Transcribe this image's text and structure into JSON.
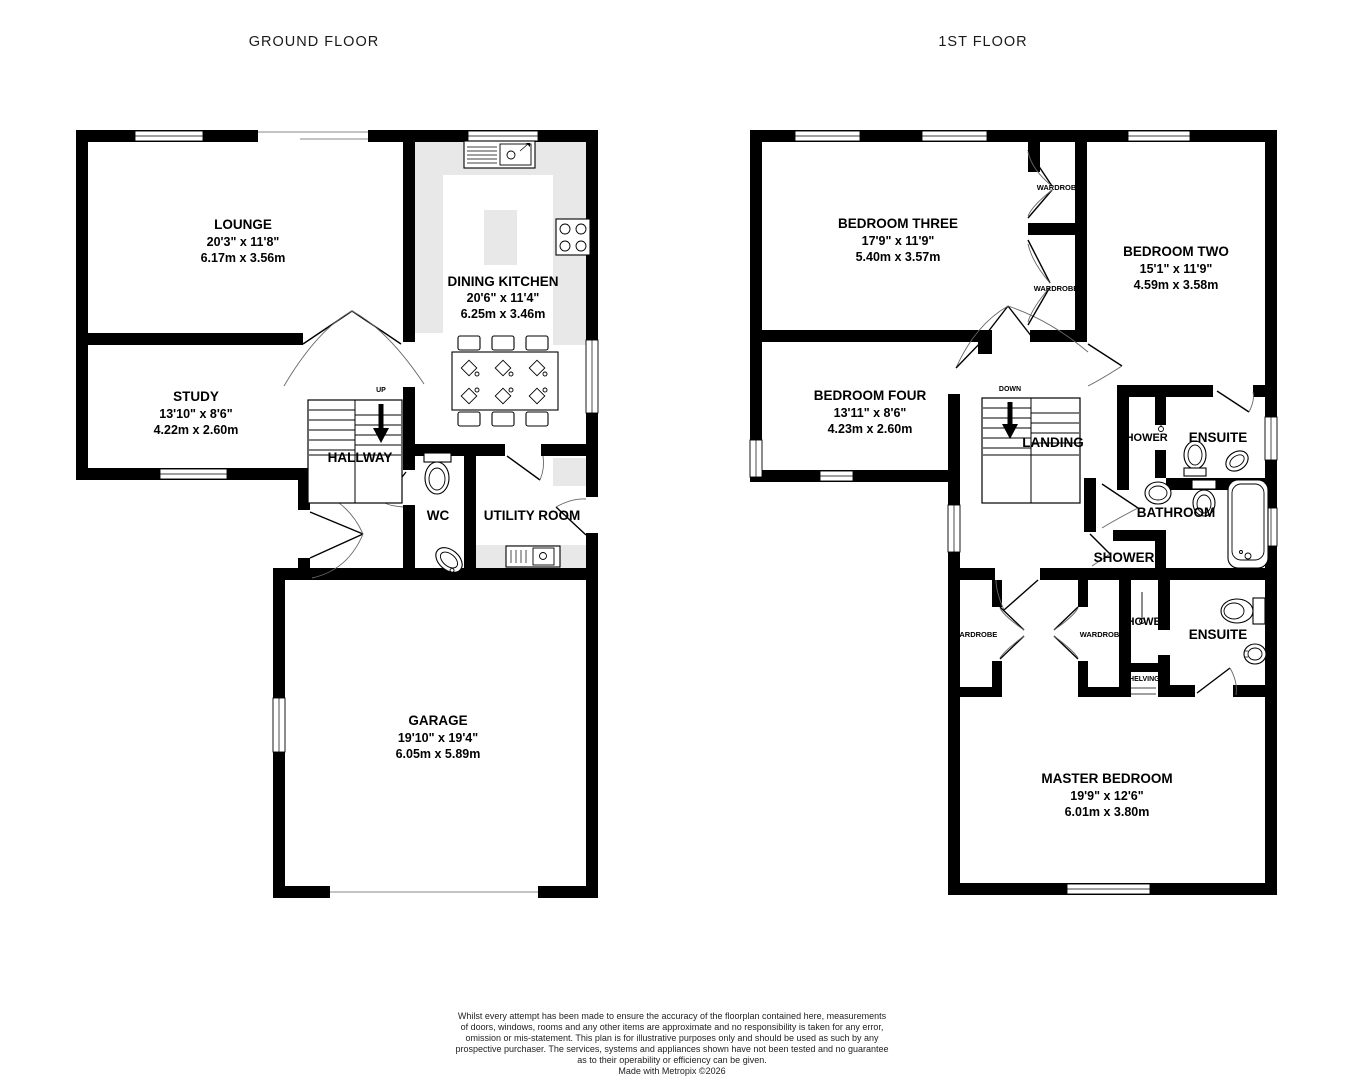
{
  "titles": {
    "ground": "GROUND FLOOR",
    "first": "1ST FLOOR"
  },
  "gf": {
    "lounge": {
      "name": "LOUNGE",
      "imp": "20'3\"  x 11'8\"",
      "met": "6.17m  x 3.56m"
    },
    "study": {
      "name": "STUDY",
      "imp": "13'10\"  x 8'6\"",
      "met": "4.22m  x 2.60m"
    },
    "kitchen": {
      "name": "DINING KITCHEN",
      "imp": "20'6\"  x 11'4\"",
      "met": "6.25m  x 3.46m"
    },
    "garage": {
      "name": "GARAGE",
      "imp": "19'10\"  x 19'4\"",
      "met": "6.05m  x 5.89m"
    },
    "hallway": "HALLWAY",
    "up": "UP",
    "wc": "WC",
    "utility": "UTILITY ROOM"
  },
  "ff": {
    "bed3": {
      "name": "BEDROOM THREE",
      "imp": "17'9\"  x 11'9\"",
      "met": "5.40m  x 3.57m"
    },
    "bed2": {
      "name": "BEDROOM TWO",
      "imp": "15'1\"  x 11'9\"",
      "met": "4.59m  x 3.58m"
    },
    "bed4": {
      "name": "BEDROOM FOUR",
      "imp": "13'11\"  x 8'6\"",
      "met": "4.23m  x 2.60m"
    },
    "master": {
      "name": "MASTER BEDROOM",
      "imp": "19'9\"  x 12'6\"",
      "met": "6.01m  x 3.80m"
    },
    "landing": "LANDING",
    "down": "DOWN",
    "wardrobe": "WARDROBE",
    "shelving": "SHELVING",
    "shower": "SHOWER",
    "ensuite": "ENSUITE",
    "bathroom": "BATHROOM"
  },
  "footer": {
    "lines": [
      "Whilst every attempt has been made to ensure the accuracy of the floorplan contained here, measurements",
      "of doors, windows, rooms and any other items are approximate and no responsibility is taken for any error,",
      "omission or mis-statement. This plan is for illustrative purposes only and should be used as such by any",
      "prospective purchaser. The services, systems and appliances shown have not been tested and no guarantee",
      "as to their operability or efficiency can be given.",
      "Made with Metropix ©2026"
    ]
  },
  "colors": {
    "wall": "#000000",
    "counter": "#e8e8e8",
    "background": "#ffffff"
  }
}
